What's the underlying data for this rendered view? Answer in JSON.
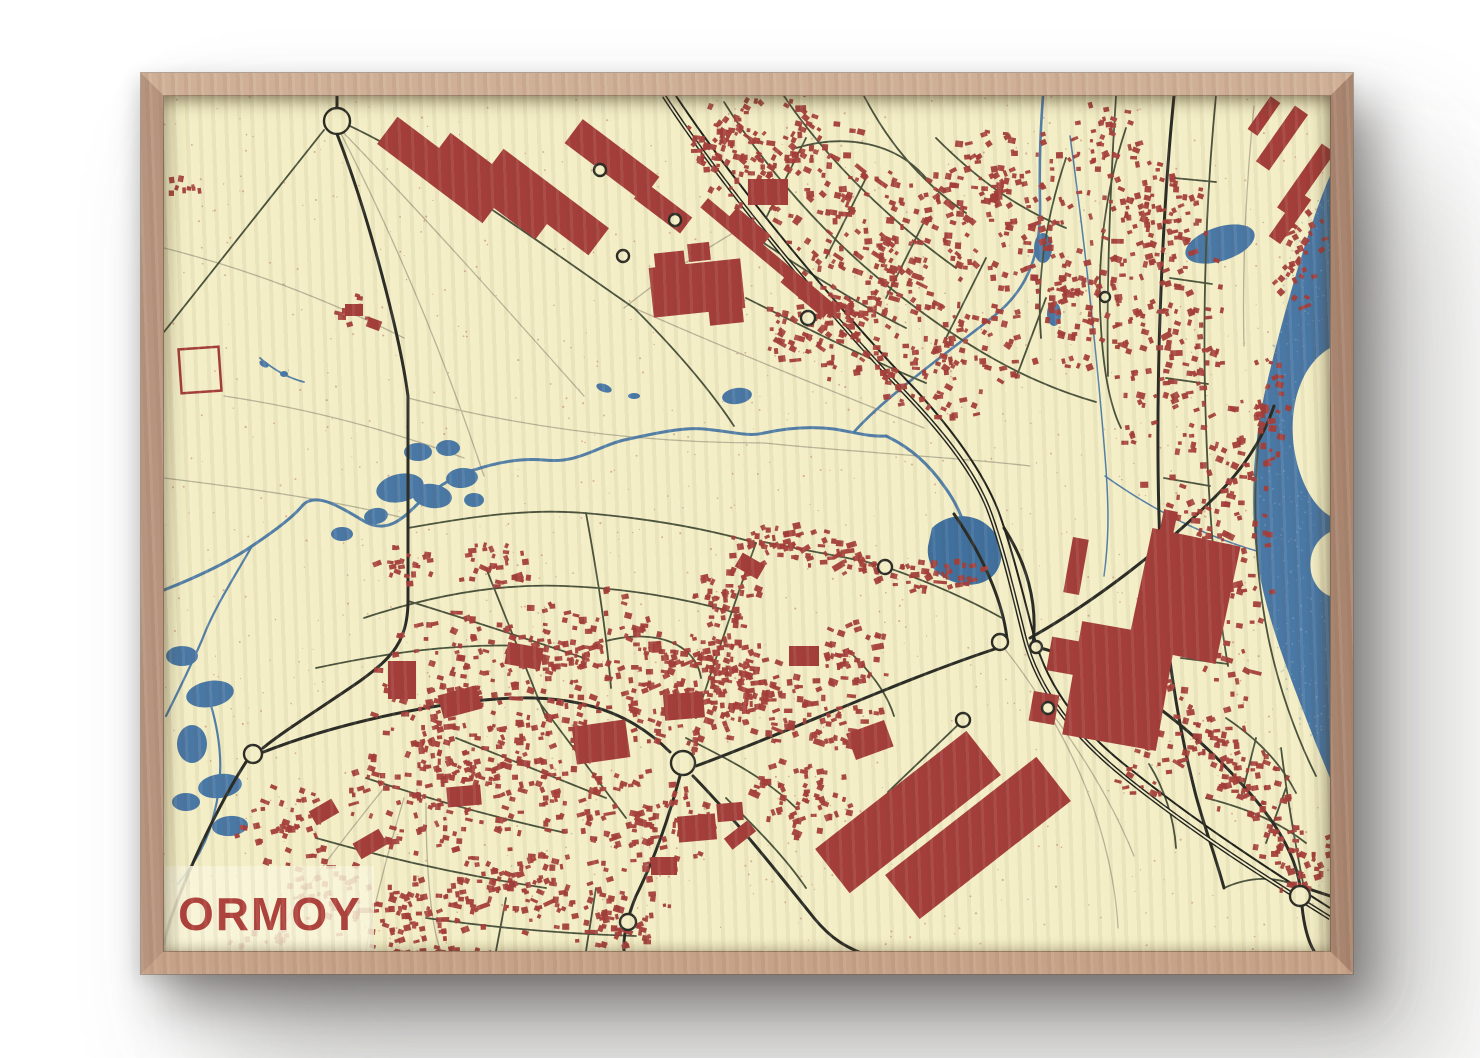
{
  "poster": {
    "title": "ORMOY"
  },
  "palette": {
    "wall": "#ffffff",
    "paper": "#f3eec5",
    "speckle": "#a94440",
    "water": "#4a78a5",
    "water_deep": "#40709d",
    "water_glint": "#7fa3c2",
    "building": "#a43e3a",
    "road_minor": "#4a523c",
    "road_major": "#2b2c26",
    "rail": "#21221d",
    "path_light": "#b7b296",
    "label_bg": "#f8f4da",
    "label_text": "#ae423c",
    "frame_wood": "#c6a288"
  },
  "map": {
    "width": 1166,
    "height": 855,
    "seed": 420,
    "speckles": {
      "count": 1100,
      "rmin": 0.5,
      "rmax": 1.1,
      "opacity": 0.38
    },
    "water_speckles": {
      "count": 260,
      "opacity": 0.5
    },
    "water": {
      "seine": "M1166,80 C1148,120 1118,220 1100,300 C1088,356 1086,420 1094,470 C1104,528 1128,586 1152,648 L1166,682 Z",
      "islands": [
        "M1166,252 C1138,268 1124,308 1130,352 C1136,390 1152,412 1166,420 Z",
        "M1166,436 C1150,444 1143,462 1148,480 C1152,492 1160,498 1166,500 Z"
      ],
      "streams": [
        {
          "d": "M0,494 C36,480 68,464 88,450 C112,434 130,420 138,410 C150,396 172,408 198,424 C226,442 244,416 258,404 C274,390 294,378 310,374 C334,366 358,362 380,364 C414,368 434,350 460,344 C492,337 520,331 540,333 C572,336 584,341 600,337 C632,330 654,331 670,333 C694,337 706,341 722,340",
          "w": 3
        },
        {
          "d": "M722,340 C748,352 766,370 780,390 C792,406 800,424 803,440",
          "w": 3
        },
        {
          "d": "M690,336 C722,300 782,258 830,220 C868,190 877,152 876,106 C875,60 877,28 879,0",
          "w": 2.6
        },
        {
          "d": "M88,450 C70,482 50,512 38,544 C24,576 12,600 2,620",
          "w": 2.2
        },
        {
          "d": "M44,600 C58,642 60,680 50,718 C44,746 30,768 14,788",
          "w": 2.2
        },
        {
          "d": "M906,40 C920,140 933,260 941,360 C946,420 944,450 940,480",
          "w": 1.5
        },
        {
          "d": "M941,380 C990,415 1040,440 1096,456",
          "w": 1.5
        },
        {
          "d": "M96,262 C110,274 124,282 140,286",
          "w": 1.8
        }
      ],
      "ponds": [
        [
          236,
          392,
          24,
          14,
          -12
        ],
        [
          268,
          400,
          20,
          12,
          8
        ],
        [
          298,
          382,
          16,
          10,
          -5
        ],
        [
          254,
          356,
          14,
          9,
          0
        ],
        [
          284,
          352,
          12,
          8,
          0
        ],
        [
          212,
          420,
          12,
          8,
          -10
        ],
        [
          178,
          438,
          11,
          7,
          0
        ],
        [
          310,
          404,
          10,
          7,
          0
        ],
        [
          573,
          300,
          15,
          8,
          -8
        ],
        [
          1056,
          148,
          36,
          17,
          -18
        ],
        [
          18,
          560,
          16,
          10,
          0
        ],
        [
          46,
          598,
          24,
          13,
          -10
        ],
        [
          28,
          648,
          15,
          19,
          0
        ],
        [
          56,
          690,
          22,
          12,
          -8
        ],
        [
          22,
          706,
          14,
          9,
          0
        ],
        [
          66,
          730,
          18,
          10,
          -5
        ],
        [
          879,
          152,
          9,
          15,
          0
        ],
        [
          890,
          218,
          7,
          12,
          0
        ],
        [
          440,
          292,
          8,
          4,
          20
        ],
        [
          470,
          300,
          6,
          3,
          0
        ],
        [
          100,
          268,
          5,
          3,
          30
        ],
        [
          120,
          278,
          4,
          3,
          0
        ],
        [
          520,
          732,
          5,
          10,
          20
        ]
      ],
      "pond_deep": "M768,432 C782,418 806,416 822,428 C838,440 842,462 832,476 C824,488 806,492 790,486 C772,480 762,468 764,450 Z"
    },
    "roads": {
      "light": [
        "M173,30 C260,120 340,210 420,300",
        "M173,30 C230,140 280,260 320,380",
        "M0,152 C80,172 160,202 240,242",
        "M60,300 C140,312 220,332 300,362",
        "M0,382 C80,392 160,402 240,422",
        "M244,302 C360,332 480,347 600,347",
        "M470,212 C560,252 660,292 760,332",
        "M600,347 C700,357 800,362 866,370",
        "M220,692 C180,742 140,792 112,842",
        "M240,702 C222,762 207,822 202,855",
        "M262,707 C262,772 267,832 277,855",
        "M840,552 C872,592 902,642 922,692 C942,742 952,792 954,832",
        "M884,612 C920,660 950,710 970,760",
        "M460,212 C500,180 545,150 590,125",
        "M1090,10 C1082,90 1078,170 1080,250",
        "M1118,260 C1112,340 1112,420 1120,500"
      ],
      "minor": [
        "M160,34 L0,236",
        "M560,6 C600,70 660,140 730,195 C800,250 862,286 932,306",
        "M620,0 C660,60 722,122 792,172",
        "M700,0 C722,42 752,82 802,117",
        "M772,42 C812,82 852,112 902,132",
        "M632,52 C682,37 732,47 762,82",
        "M562,122 C622,162 682,202 742,232",
        "M582,202 C642,232 702,262 762,287",
        "M642,42 L602,122",
        "M702,82 L662,162",
        "M762,122 L722,202",
        "M822,162 L782,242",
        "M882,202 L852,282",
        "M902,62 C882,122 872,182 877,242",
        "M962,32 C942,92 932,162 937,232 C940,282 947,312 957,332",
        "M1052,0 C1042,100 1038,220 1042,330 C1045,420 1052,500 1064,570",
        "M952,0 C947,80 942,180 944,280",
        "M1010,82 L1052,86",
        "M1006,182 L1048,188",
        "M1002,282 L1044,288",
        "M1000,382 L1046,390",
        "M1004,482 L1054,492",
        "M1017,562 L1064,568",
        "M1096,332 C1088,402 1090,470 1104,540 C1114,590 1132,640 1152,680",
        "M244,432 C300,422 360,412 420,417 C480,422 540,432 592,447",
        "M200,522 C260,502 330,487 400,490 C460,492 520,502 572,517",
        "M152,572 C222,557 292,547 362,550",
        "M244,505 C300,522 360,542 420,562",
        "M322,472 C342,522 362,572 382,622",
        "M422,417 C432,472 442,532 447,592",
        "M592,447 C572,502 552,562 532,622",
        "M372,602 C402,642 432,682 462,722",
        "M292,642 C342,662 392,682 442,702",
        "M202,682 C262,702 332,722 402,737",
        "M152,742 C222,762 302,780 382,792",
        "M262,822 C332,832 402,838 472,840",
        "M332,855 L342,802",
        "M422,855 L432,792",
        "M442,545 C492,532 532,548 537,582",
        "M522,642 C562,662 602,682 632,712",
        "M562,702 C592,732 622,762 642,792",
        "M1062,622 C1092,642 1117,667 1132,697",
        "M1042,702 C1082,712 1117,727 1142,747",
        "M1092,642 L1077,702",
        "M1122,692 L1102,747",
        "M1060,792 C1082,782 1112,777 1140,794",
        "M186,30 C280,75 380,150 470,212",
        "M470,212 C510,252 545,292 570,330",
        "M600,446 C660,458 700,464 722,471 C762,485 802,502 838,522",
        "M985,668 C1000,692 1010,722 1012,752",
        "M1140,792 C1130,742 1122,692 1117,652",
        "M797,626 C770,652 745,676 724,696",
        "M690,560 C710,580 724,600 730,620"
      ],
      "major": [
        "M173,38 C205,120 236,240 244,300 L244,505 C244,545 228,562 196,585 C160,610 118,636 99,652",
        "M82,666 C60,700 34,752 16,798 C8,818 2,836 0,848",
        "M97,657 C180,624 300,600 370,602 C430,604 472,622 506,656",
        "M532,670 C620,638 740,582 840,550",
        "M868,550 C950,568 1030,632 1090,702 C1118,735 1132,764 1136,790",
        "M516,680 C505,720 492,760 472,800 C463,822 459,840 460,855",
        "M529,680 C570,722 610,772 650,822 C668,844 684,852 700,858",
        "M1010,0 C998,120 990,300 996,450 C1000,540 1012,622 1032,700 C1042,736 1052,762 1060,792",
        "M173,12 L173,0",
        "M790,418 C826,470 840,515 843,543",
        "M869,547 C874,506 862,466 840,432",
        "M866,542 C930,506 1000,452 1052,400 C1082,370 1100,340 1110,310",
        "M1136,790 L1166,800",
        "M1138,810 C1140,830 1144,845 1150,855"
      ],
      "rail": [
        {
          "d": "M500,0 C560,92 660,212 740,296 C788,346 812,382 824,412 C838,448 850,500 860,540 C874,596 912,642 962,682 C1032,738 1102,782 1166,822",
          "w": 4.6,
          "core": 1.7
        },
        {
          "d": "M512,0 C572,90 670,208 750,292 C798,344 822,384 834,414 C848,452 860,502 870,540 C884,594 920,638 970,676 C1038,730 1106,774 1166,812",
          "w": 2.0,
          "core": 0
        }
      ]
    },
    "roundabouts": [
      [
        173,
        25,
        13
      ],
      [
        89,
        658,
        9
      ],
      [
        519,
        667,
        12
      ],
      [
        464,
        826,
        8
      ],
      [
        1136,
        800,
        10
      ],
      [
        436,
        74,
        6
      ],
      [
        511,
        124,
        6
      ],
      [
        459,
        160,
        6
      ],
      [
        644,
        222,
        7
      ],
      [
        836,
        546,
        8
      ],
      [
        872,
        551,
        6
      ],
      [
        799,
        624,
        7
      ],
      [
        884,
        612,
        6
      ],
      [
        721,
        471,
        7
      ],
      [
        941,
        201,
        5
      ]
    ],
    "big_buildings": [
      [
        276,
        74,
        132,
        34,
        37
      ],
      [
        329,
        90,
        132,
        34,
        37
      ],
      [
        382,
        106,
        132,
        34,
        37
      ],
      [
        448,
        64,
        96,
        30,
        37
      ],
      [
        499,
        112,
        58,
        20,
        37
      ],
      [
        533,
        192,
        92,
        50,
        -6
      ],
      [
        506,
        168,
        30,
        24,
        -6
      ],
      [
        562,
        218,
        34,
        20,
        -6
      ],
      [
        535,
        156,
        22,
        18,
        -6
      ],
      [
        606,
        162,
        172,
        12,
        40
      ],
      [
        643,
        198,
        56,
        16,
        40
      ],
      [
        586,
        130,
        44,
        12,
        40
      ],
      [
        604,
        96,
        40,
        26,
        0
      ],
      [
        1118,
        42,
        68,
        16,
        -55
      ],
      [
        1142,
        84,
        78,
        16,
        -55
      ],
      [
        1126,
        122,
        54,
        14,
        -55
      ],
      [
        1100,
        20,
        40,
        12,
        -55
      ],
      [
        1020,
        500,
        90,
        120,
        12
      ],
      [
        955,
        590,
        95,
        115,
        10
      ],
      [
        900,
        560,
        30,
        34,
        10
      ],
      [
        880,
        612,
        26,
        30,
        10
      ],
      [
        1002,
        438,
        14,
        48,
        12
      ],
      [
        912,
        470,
        16,
        56,
        10
      ],
      [
        744,
        716,
        192,
        56,
        -38
      ],
      [
        814,
        742,
        192,
        56,
        -38
      ],
      [
        576,
        739,
        30,
        14,
        -38
      ],
      [
        437,
        646,
        54,
        38,
        -8
      ],
      [
        520,
        610,
        40,
        26,
        -5
      ],
      [
        360,
        560,
        36,
        22,
        10
      ],
      [
        296,
        606,
        40,
        24,
        -15
      ],
      [
        238,
        584,
        28,
        38,
        0
      ],
      [
        706,
        644,
        40,
        28,
        -20
      ],
      [
        640,
        560,
        30,
        20,
        0
      ],
      [
        586,
        470,
        26,
        16,
        30
      ],
      [
        300,
        700,
        34,
        20,
        -5
      ],
      [
        206,
        748,
        30,
        18,
        -30
      ],
      [
        160,
        716,
        26,
        16,
        -30
      ],
      [
        533,
        732,
        38,
        26,
        -5
      ],
      [
        566,
        716,
        26,
        18,
        -5
      ],
      [
        500,
        770,
        26,
        18,
        0
      ],
      [
        190,
        214,
        18,
        12,
        0
      ],
      [
        210,
        228,
        14,
        10,
        20
      ]
    ],
    "farm_outline": {
      "x": 16,
      "y": 252,
      "w": 40,
      "h": 44,
      "rot": -4
    },
    "clusters": [
      [
        620,
        60,
        85,
        70,
        120,
        20
      ],
      [
        720,
        150,
        95,
        80,
        150,
        20
      ],
      [
        840,
        95,
        85,
        65,
        115,
        -10
      ],
      [
        900,
        205,
        85,
        70,
        115,
        0
      ],
      [
        780,
        265,
        75,
        60,
        95,
        10
      ],
      [
        985,
        120,
        60,
        55,
        70,
        0
      ],
      [
        660,
        235,
        60,
        50,
        75,
        15
      ],
      [
        560,
        40,
        40,
        40,
        40,
        20
      ],
      [
        940,
        40,
        40,
        35,
        35,
        0
      ],
      [
        1005,
        250,
        55,
        175,
        150,
        -3
      ],
      [
        1062,
        480,
        48,
        140,
        110,
        5
      ],
      [
        985,
        610,
        55,
        105,
        80,
        8
      ],
      [
        1100,
        330,
        32,
        75,
        45,
        0
      ],
      [
        1135,
        160,
        28,
        60,
        40,
        -40
      ],
      [
        300,
        600,
        95,
        85,
        150,
        0
      ],
      [
        420,
        560,
        85,
        70,
        130,
        0
      ],
      [
        520,
        600,
        70,
        60,
        100,
        0
      ],
      [
        380,
        680,
        85,
        65,
        120,
        0
      ],
      [
        260,
        700,
        75,
        60,
        100,
        0
      ],
      [
        480,
        730,
        70,
        55,
        95,
        0
      ],
      [
        600,
        600,
        60,
        48,
        80,
        0
      ],
      [
        640,
        700,
        50,
        45,
        60,
        0
      ],
      [
        350,
        790,
        70,
        50,
        85,
        0
      ],
      [
        450,
        820,
        60,
        38,
        65,
        0
      ],
      [
        250,
        820,
        60,
        42,
        65,
        0
      ],
      [
        550,
        560,
        50,
        40,
        60,
        0
      ],
      [
        620,
        450,
        70,
        22,
        55,
        -8
      ],
      [
        690,
        560,
        40,
        34,
        40,
        0
      ],
      [
        680,
        620,
        42,
        36,
        45,
        0
      ],
      [
        560,
        500,
        40,
        30,
        40,
        0
      ],
      [
        770,
        480,
        60,
        16,
        40,
        -8
      ],
      [
        700,
        470,
        30,
        12,
        20,
        -8
      ],
      [
        1090,
        690,
        48,
        40,
        55,
        0
      ],
      [
        1130,
        760,
        42,
        36,
        48,
        0
      ],
      [
        1055,
        645,
        30,
        26,
        28,
        0
      ],
      [
        190,
        215,
        20,
        16,
        10,
        0
      ],
      [
        692,
        218,
        38,
        30,
        32,
        15
      ],
      [
        120,
        730,
        50,
        40,
        40,
        0
      ],
      [
        160,
        800,
        52,
        42,
        42,
        0
      ],
      [
        95,
        852,
        40,
        26,
        20,
        0
      ],
      [
        290,
        860,
        60,
        20,
        25,
        0
      ],
      [
        20,
        90,
        26,
        14,
        10,
        0
      ],
      [
        330,
        470,
        40,
        24,
        30,
        0
      ],
      [
        240,
        470,
        30,
        20,
        20,
        0
      ]
    ],
    "label": {
      "x": 0,
      "y": 770,
      "w": 210,
      "h": 85,
      "opacity": 0.86,
      "text_x": 14,
      "text_y": 834,
      "font_size": 46,
      "letter_spacing": 2
    }
  }
}
